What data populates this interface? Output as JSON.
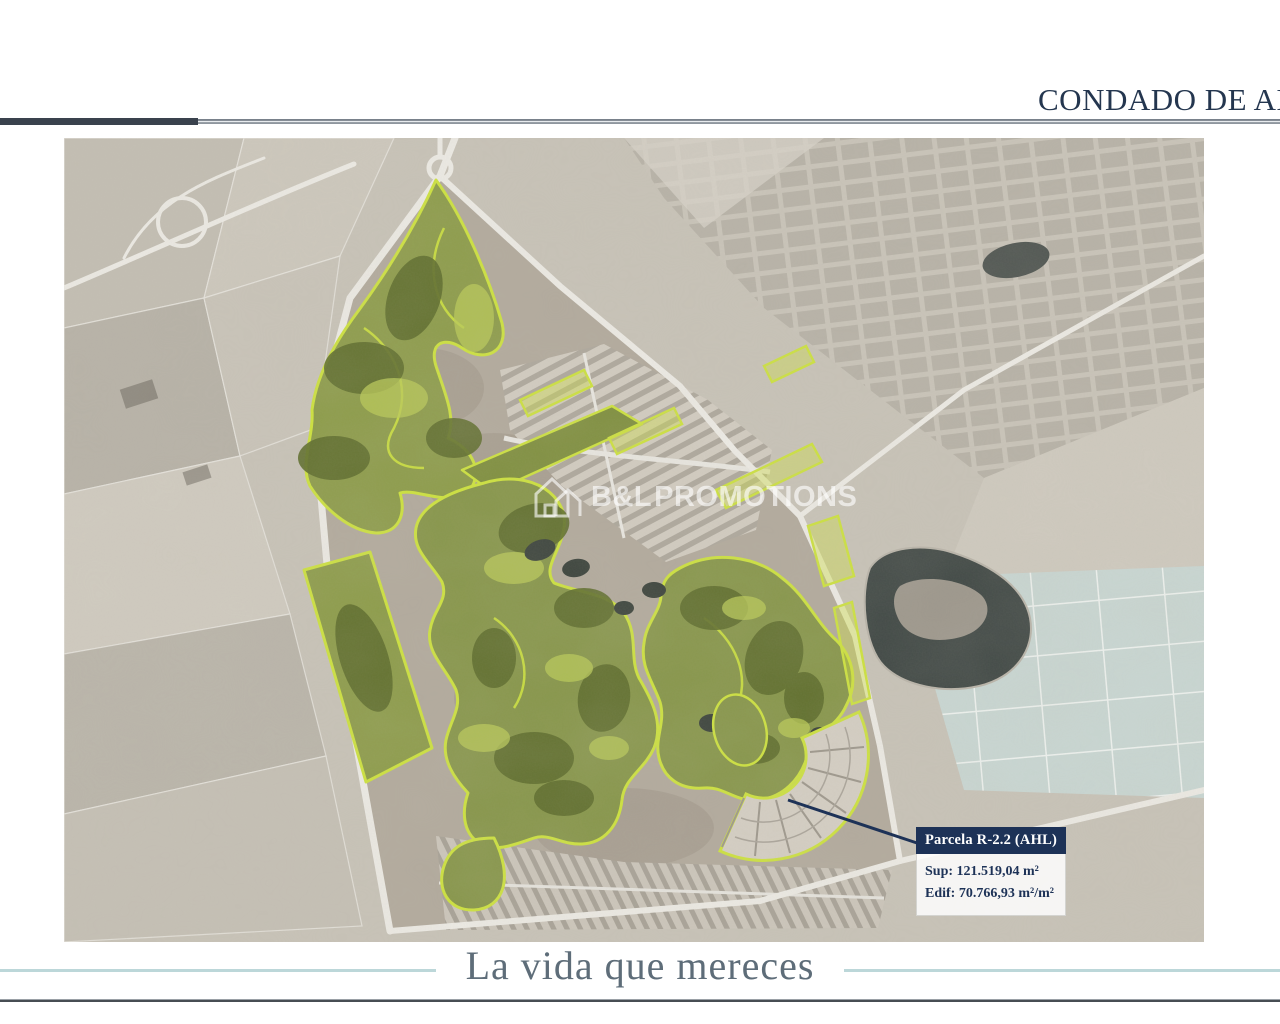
{
  "header": {
    "title": "CONDADO DE ALH",
    "title_color": "#24364f"
  },
  "map": {
    "description": "aerial satellite masterplan with golf areas highlighted",
    "watermark": {
      "icon": "house-logo-icon",
      "text": "B&L PROMOTIONS"
    },
    "callout": {
      "title": "Parcela R-2.2 (AHL)",
      "sup_line": "Sup: 121.519,04 m²",
      "edif_line": "Edif: 70.766,93 m²/m²",
      "header_bg": "#1d3257",
      "text_color": "#1d3257"
    },
    "colors": {
      "highlight_outline": "#cde23e",
      "golf_green": "#87964a",
      "terrain": "#c8c3b8",
      "lake": "#3f4744",
      "teal_fields": "#c9d7d3"
    }
  },
  "footer": {
    "tagline": "La vida que mereces",
    "tagline_color": "#5e6d79",
    "accent_line_color": "#bcd7d9",
    "rule_color": "#474d53"
  }
}
